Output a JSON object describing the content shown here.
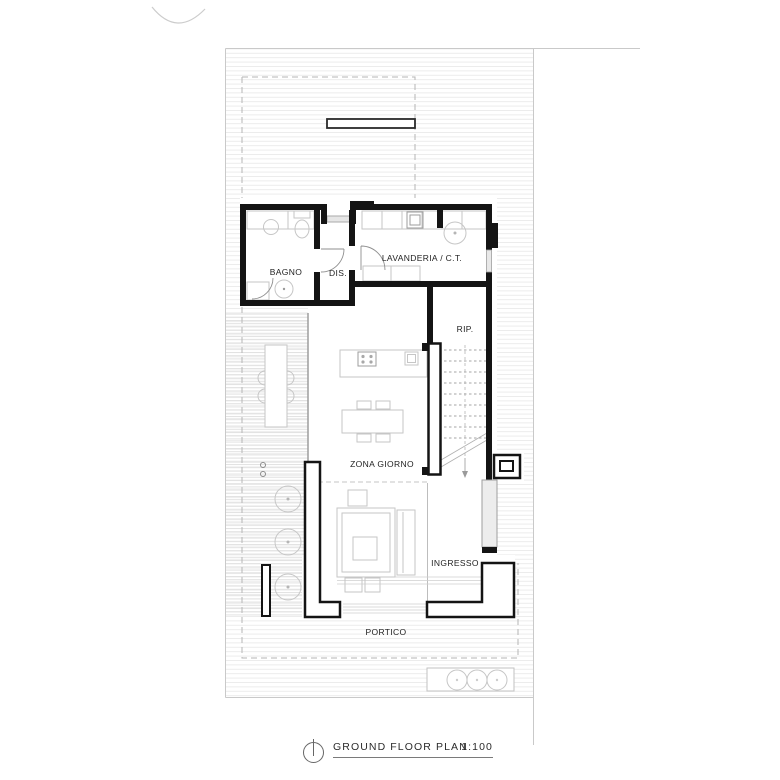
{
  "rooms": [
    {
      "id": "bagno",
      "label": "BAGNO"
    },
    {
      "id": "dis",
      "label": "DIS."
    },
    {
      "id": "lavanderia",
      "label": "LAVANDERIA / C.T."
    },
    {
      "id": "rip",
      "label": "RIP."
    },
    {
      "id": "zona-giorno",
      "label": "ZONA GIORNO"
    },
    {
      "id": "ingresso",
      "label": "INGRESSO"
    },
    {
      "id": "portico",
      "label": "PORTICO"
    }
  ],
  "title": {
    "name": "GROUND FLOOR PLAN",
    "scale": "1:100"
  },
  "colors": {
    "wall": "#141414",
    "furniture_line": "#c6c6c6",
    "site_line": "#c9c9c9",
    "hatch": "#ebebeb"
  }
}
